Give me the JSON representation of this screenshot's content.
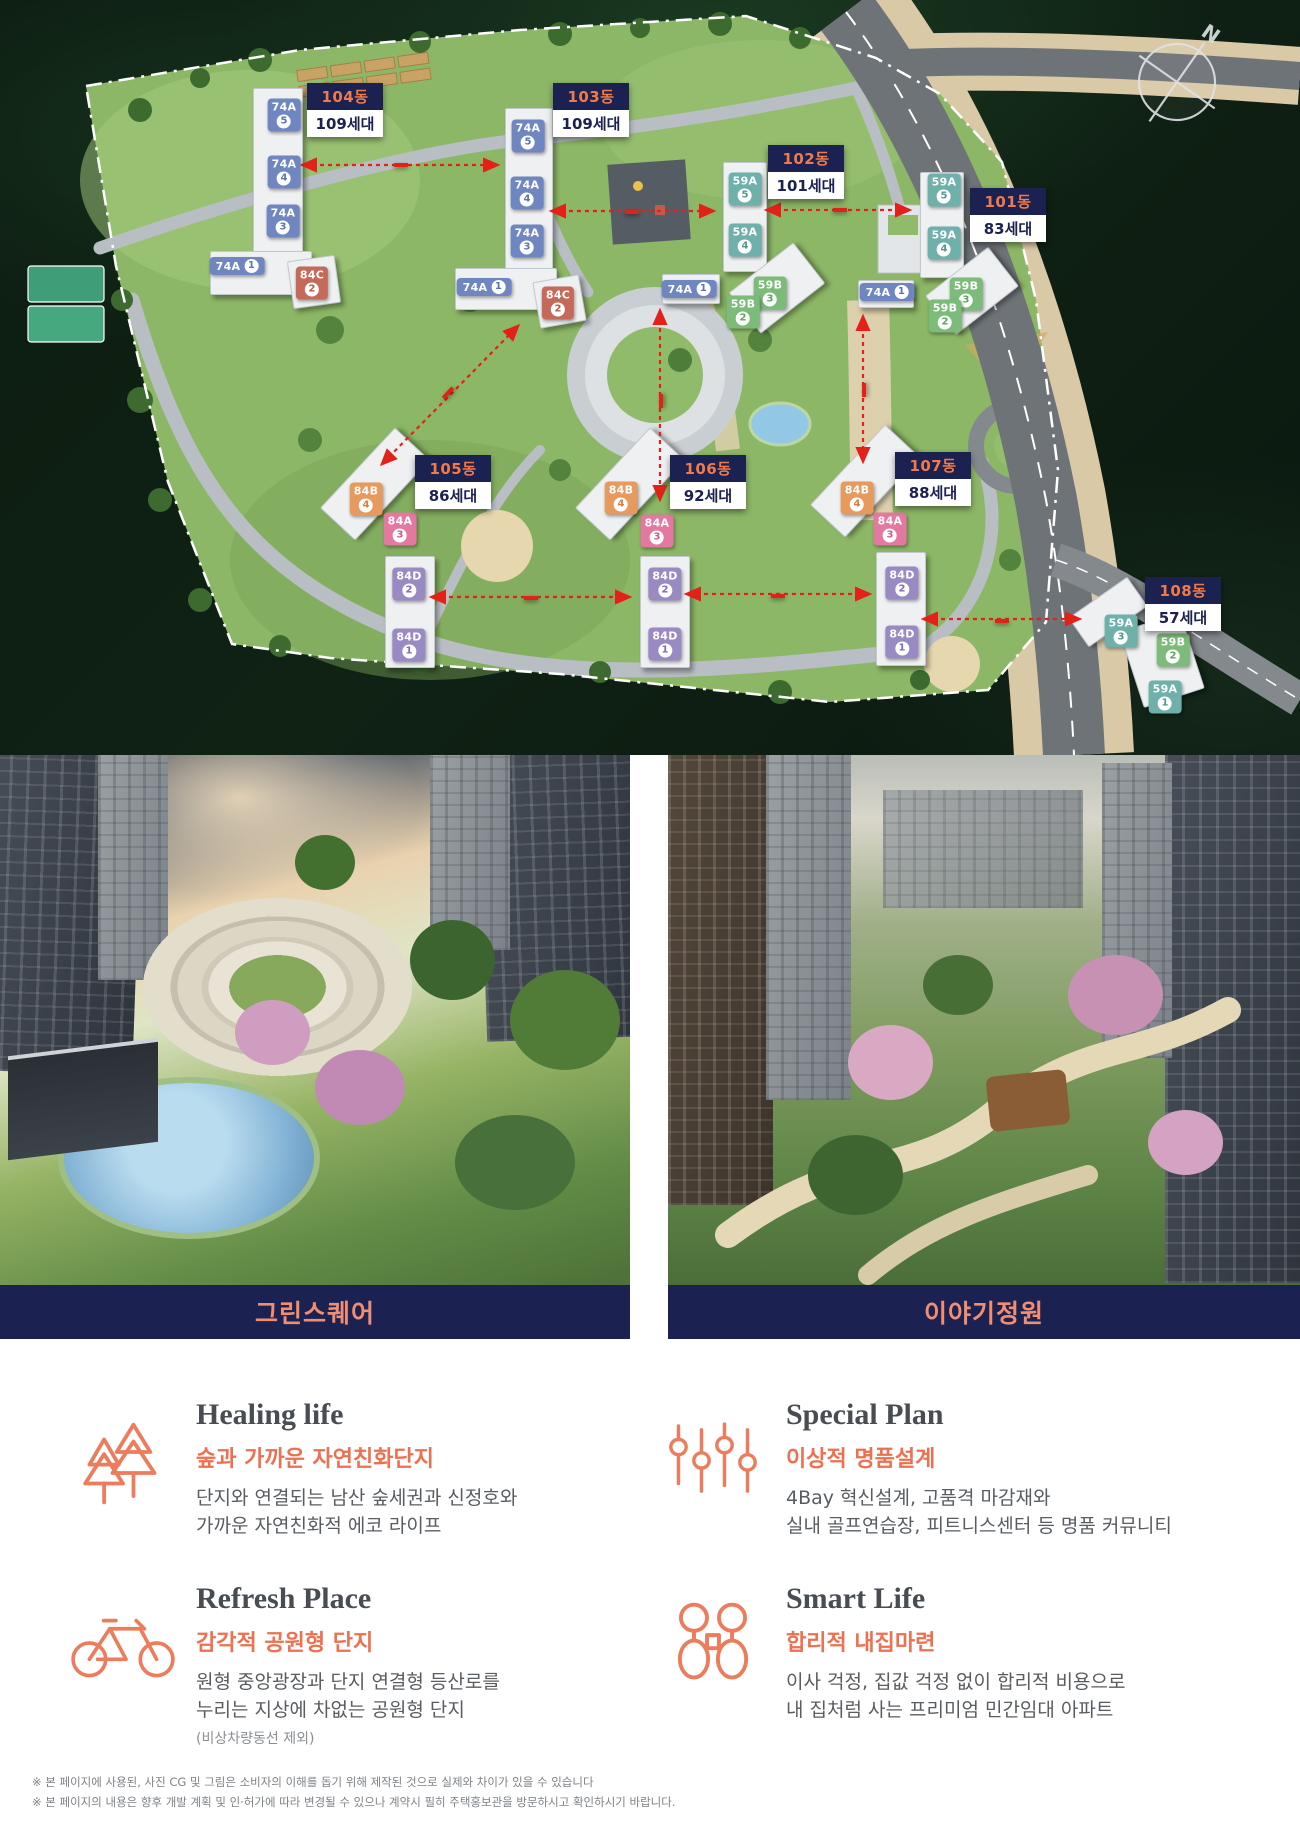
{
  "site_plan": {
    "compass": "N",
    "blocks": [
      {
        "name": "104동",
        "units": "109세대",
        "x": 307,
        "y": 83
      },
      {
        "name": "103동",
        "units": "109세대",
        "x": 553,
        "y": 83
      },
      {
        "name": "102동",
        "units": "101세대",
        "x": 768,
        "y": 145
      },
      {
        "name": "101동",
        "units": "83세대",
        "x": 970,
        "y": 188
      },
      {
        "name": "105동",
        "units": "86세대",
        "x": 415,
        "y": 455
      },
      {
        "name": "106동",
        "units": "92세대",
        "x": 670,
        "y": 455
      },
      {
        "name": "107동",
        "units": "88세대",
        "x": 895,
        "y": 452
      },
      {
        "name": "108동",
        "units": "57세대",
        "x": 1145,
        "y": 577
      }
    ],
    "distances": [
      {
        "label": "48.6m",
        "x": 401,
        "y": 165,
        "rot": 0
      },
      {
        "label": "42.6m",
        "x": 632,
        "y": 212,
        "rot": 0
      },
      {
        "label": "47.3m",
        "x": 840,
        "y": 210,
        "rot": 0
      },
      {
        "label": "54.0m",
        "x": 448,
        "y": 393,
        "rot": -47
      },
      {
        "label": "48.9m",
        "x": 661,
        "y": 401,
        "rot": -90
      },
      {
        "label": "39.6m",
        "x": 864,
        "y": 390,
        "rot": -90
      },
      {
        "label": "51.0m",
        "x": 531,
        "y": 598,
        "rot": 0
      },
      {
        "label": "46.4m",
        "x": 778,
        "y": 596,
        "rot": 0
      },
      {
        "label": "40.6m",
        "x": 1002,
        "y": 621,
        "rot": 0
      }
    ],
    "unit_chips": [
      {
        "t": "74A",
        "n": "5",
        "x": 284,
        "y": 115
      },
      {
        "t": "74A",
        "n": "4",
        "x": 284,
        "y": 172
      },
      {
        "t": "74A",
        "n": "3",
        "x": 283,
        "y": 221
      },
      {
        "t": "74A",
        "n": "1",
        "x": 237,
        "y": 266,
        "w": 1
      },
      {
        "t": "84C",
        "n": "2",
        "x": 312,
        "y": 283
      },
      {
        "t": "74A",
        "n": "5",
        "x": 528,
        "y": 136
      },
      {
        "t": "74A",
        "n": "4",
        "x": 527,
        "y": 193
      },
      {
        "t": "74A",
        "n": "3",
        "x": 527,
        "y": 241
      },
      {
        "t": "74A",
        "n": "1",
        "x": 484,
        "y": 287,
        "w": 1
      },
      {
        "t": "84C",
        "n": "2",
        "x": 558,
        "y": 303
      },
      {
        "t": "59A",
        "n": "5",
        "x": 745,
        "y": 189
      },
      {
        "t": "59A",
        "n": "4",
        "x": 745,
        "y": 240
      },
      {
        "t": "74A",
        "n": "1",
        "x": 689,
        "y": 289,
        "w": 1
      },
      {
        "t": "59B",
        "n": "3",
        "x": 770,
        "y": 293
      },
      {
        "t": "59B",
        "n": "2",
        "x": 743,
        "y": 312
      },
      {
        "t": "59A",
        "n": "5",
        "x": 944,
        "y": 190
      },
      {
        "t": "59A",
        "n": "4",
        "x": 944,
        "y": 243
      },
      {
        "t": "74A",
        "n": "1",
        "x": 887,
        "y": 292,
        "w": 1
      },
      {
        "t": "59B",
        "n": "3",
        "x": 966,
        "y": 294
      },
      {
        "t": "59B",
        "n": "2",
        "x": 945,
        "y": 316
      },
      {
        "t": "84B",
        "n": "4",
        "x": 366,
        "y": 499
      },
      {
        "t": "84A",
        "n": "3",
        "x": 400,
        "y": 529
      },
      {
        "t": "84D",
        "n": "2",
        "x": 409,
        "y": 584
      },
      {
        "t": "84D",
        "n": "1",
        "x": 409,
        "y": 645
      },
      {
        "t": "84B",
        "n": "4",
        "x": 621,
        "y": 498
      },
      {
        "t": "84A",
        "n": "3",
        "x": 657,
        "y": 531
      },
      {
        "t": "84D",
        "n": "2",
        "x": 665,
        "y": 584
      },
      {
        "t": "84D",
        "n": "1",
        "x": 665,
        "y": 644
      },
      {
        "t": "84B",
        "n": "4",
        "x": 857,
        "y": 498
      },
      {
        "t": "84A",
        "n": "3",
        "x": 890,
        "y": 529
      },
      {
        "t": "84D",
        "n": "2",
        "x": 902,
        "y": 583
      },
      {
        "t": "84D",
        "n": "1",
        "x": 902,
        "y": 642
      },
      {
        "t": "59A",
        "n": "3",
        "x": 1121,
        "y": 631
      },
      {
        "t": "59B",
        "n": "2",
        "x": 1173,
        "y": 650
      },
      {
        "t": "59A",
        "n": "1",
        "x": 1165,
        "y": 697
      }
    ]
  },
  "gallery": [
    {
      "caption": "그린스퀘어"
    },
    {
      "caption": "이야기정원"
    }
  ],
  "features": [
    {
      "title": "Healing life",
      "subtitle": "숲과 가까운 자연친화단지",
      "body": "단지와 연결되는 남산 숲세권과 신정호와\n가까운 자연친화적 에코 라이프"
    },
    {
      "title": "Special Plan",
      "subtitle": "이상적 명품설계",
      "body": "4Bay 혁신설계, 고품격 마감재와\n실내 골프연습장, 피트니스센터 등 명품 커뮤니티"
    },
    {
      "title": "Refresh Place",
      "subtitle": "감각적 공원형 단지",
      "body": "원형 중앙광장과 단지 연결형 등산로를\n누리는 지상에 차없는 공원형 단지",
      "note": "(비상차량동선 제외)"
    },
    {
      "title": "Smart Life",
      "subtitle": "합리적 내집마련",
      "body": "이사 걱정, 집값 걱정 없이 합리적 비용으로\n내 집처럼 사는 프리미엄 민간임대 아파트"
    }
  ],
  "footer": {
    "line1": "※ 본 페이지에 사용된, 사진 CG 및 그림은 소비자의 이해를 돕기 위해 제작된 것으로 실제와 차이가 있을 수 있습니다",
    "line2": "※ 본 페이지의 내용은 향후 개발 계획 및 인·허가에 따라 변경될 수 있으나 계약시 필히 주택홍보관을 방문하시고 확인하시기 바랍니다."
  },
  "colors": {
    "navy": "#1b2150",
    "label_orange": "#ef7b4b",
    "distance_red": "#e32119",
    "accent_orange": "#ed7c5c",
    "unit_74A": "#6f86c0",
    "unit_84C": "#c56a5b",
    "unit_59A": "#6fb0ab",
    "unit_59B": "#7cbb79",
    "unit_84B": "#e79a5d",
    "unit_84A": "#e378a0",
    "unit_84D": "#9a8ac4"
  }
}
